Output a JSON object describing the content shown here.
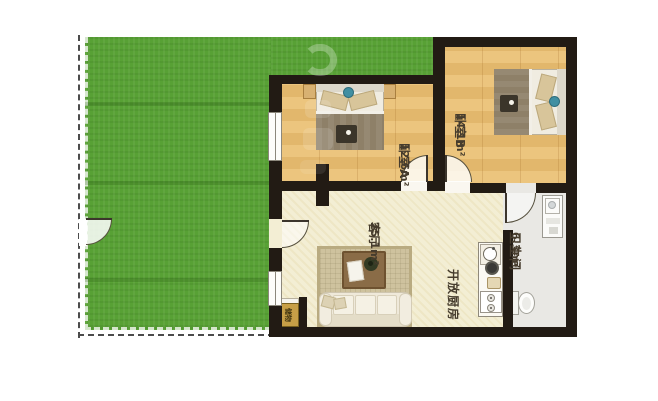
{
  "title": "floor-plan-with-private-garden",
  "colors": {
    "grass": "#58a135",
    "wall": "#221b14",
    "wood_floor": "#e9c178",
    "living_floor": "#f3eed4",
    "bath_floor": "#e9e8e4",
    "rug": "#cec29e",
    "blanket": "#8e8068",
    "accent_teal": "#418fa2",
    "storage_fill": "#c79f47",
    "boundary_dash": "#4b4b4b"
  },
  "rooms": {
    "bedroom_a": {
      "name": "卧室A",
      "area": "12.6m²"
    },
    "bedroom_b": {
      "name": "卧室B",
      "area": "14.1m²"
    },
    "living_room": {
      "name": "客厅",
      "area": "25.1m²"
    },
    "kitchen": {
      "name": "开放厨房"
    },
    "bathroom": {
      "name": "卫生间",
      "area": "6.3m²"
    },
    "storage": {
      "name": "储物"
    }
  },
  "icons": {
    "double_bed": "bed-icon",
    "sofa": "sofa-icon",
    "coffee_table": "coffee-table-icon",
    "rug": "rug-icon",
    "sink": "sink-icon",
    "stove": "stove-icon",
    "toilet": "toilet-icon",
    "washbasin": "washbasin-icon",
    "door_swing": "door-arc-icon",
    "window": "window-icon",
    "lawn": "lawn-icon"
  }
}
